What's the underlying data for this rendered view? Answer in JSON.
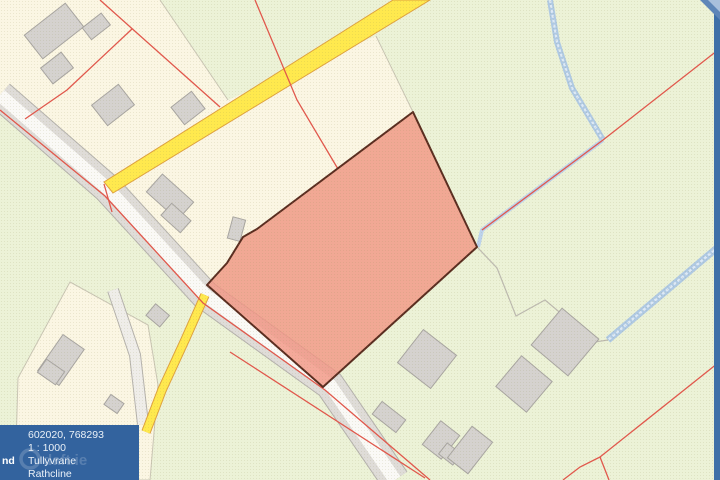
{
  "map_viewer": {
    "description": "Cadastral land-registry map with a highlighted parcel",
    "info_panel": {
      "coordinates": "602020, 768293",
      "scale": "1 : 1000",
      "townland": "Tullyvrane",
      "electoral_division": "Rathcline",
      "clipped_left_label": "nd",
      "background_color": "#33639E",
      "text_color": "#EAF1F8"
    },
    "watermark": {
      "text": "daft.ie"
    },
    "legend_colors": {
      "field_cream": "#FBF6E3",
      "field_green": "#ECF2D7",
      "road_yellow": "#FFE94E",
      "road_yellow_border": "#DFA23E",
      "road_carriageway_white": "#FAF9F6",
      "road_verge_gray": "#DFDCD8",
      "selected_parcel_fill": "#F29583",
      "selected_parcel_border": "#5A2D20",
      "boundary_line_red": "#E2574C",
      "stream_blue": "#A9C4E4",
      "building_gray": "#D5D2CF",
      "map_edge_strip_blue": "#3E70A8"
    }
  }
}
